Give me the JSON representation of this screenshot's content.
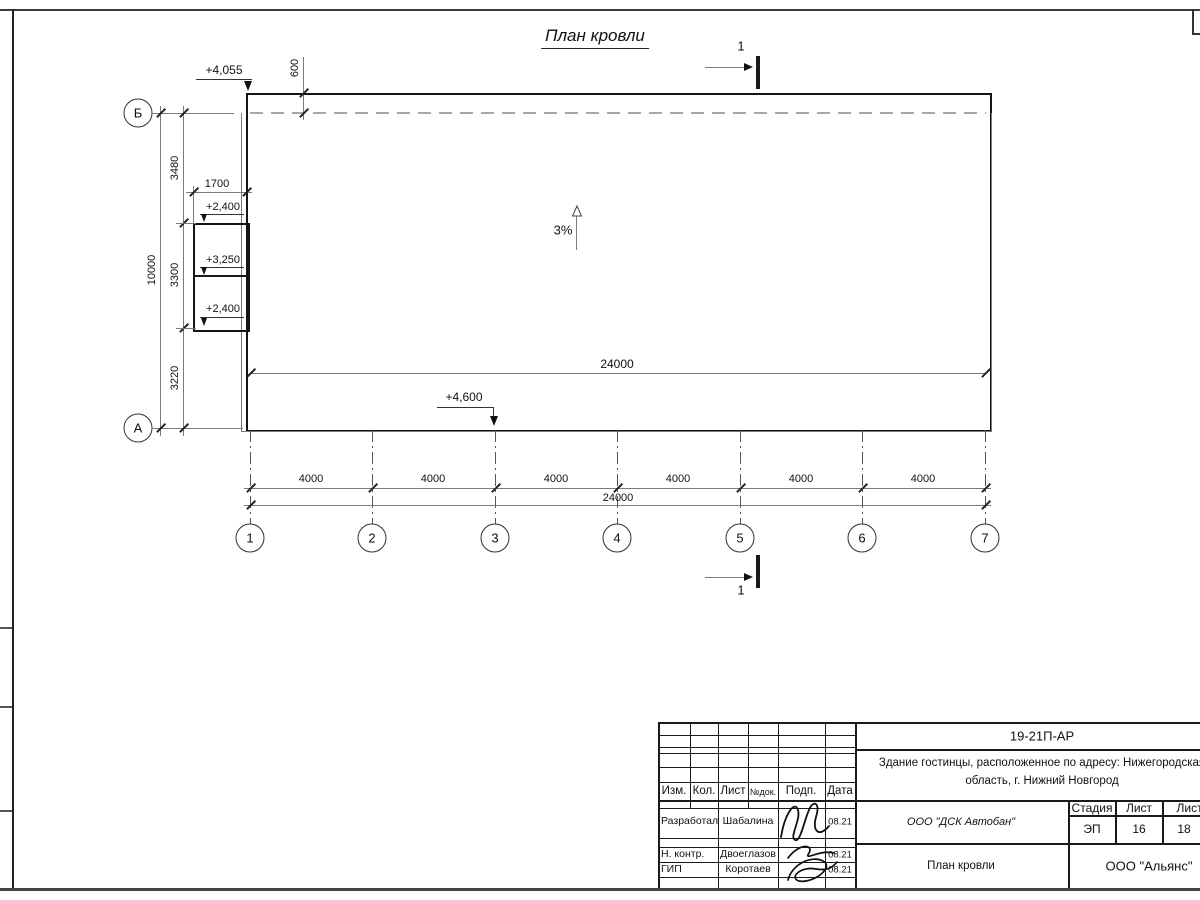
{
  "title": "План кровли",
  "section_mark": {
    "label": "1"
  },
  "slope": {
    "label": "3%"
  },
  "elevations": {
    "top_left": "+4,055",
    "annex_top": "+2,400",
    "annex_mid": "+3,250",
    "annex_bottom": "+2,400",
    "bottom": "+4,600"
  },
  "axes": {
    "rows": [
      "Б",
      "А"
    ],
    "columns": [
      "1",
      "2",
      "3",
      "4",
      "5",
      "6",
      "7"
    ]
  },
  "dimensions": {
    "top_offset": "600",
    "annex_width": "1700",
    "inner_total": "24000",
    "bottom_segments": [
      "4000",
      "4000",
      "4000",
      "4000",
      "4000",
      "4000"
    ],
    "bottom_total": "24000",
    "left_segments": [
      "3480",
      "3300",
      "3220"
    ],
    "left_total": "10000"
  },
  "title_block": {
    "doc_number": "19-21П-АР",
    "project_line1": "Здание гостинцы, расположенное по адресу: Нижегородская",
    "project_line2": "область, г. Нижний Новгород",
    "header_cells": [
      "Изм.",
      "Кол.",
      "Лист",
      "№док.",
      "Подп.",
      "Дата"
    ],
    "rows": [
      {
        "role": "Разработал",
        "name": "Шабалина",
        "date": "08.21"
      },
      {
        "role": "Н. контр.",
        "name": "Двоеглазов",
        "date": "08.21"
      },
      {
        "role": "ГИП",
        "name": "Коротаев",
        "date": "08.21"
      }
    ],
    "company": "ООО \"ДСК Автобан\"",
    "stage_header": [
      "Стадия",
      "Лист",
      "Листов"
    ],
    "stage_values": [
      "ЭП",
      "16",
      "18"
    ],
    "sheet_title": "План кровли",
    "org": "ООО \"Альянс\""
  }
}
